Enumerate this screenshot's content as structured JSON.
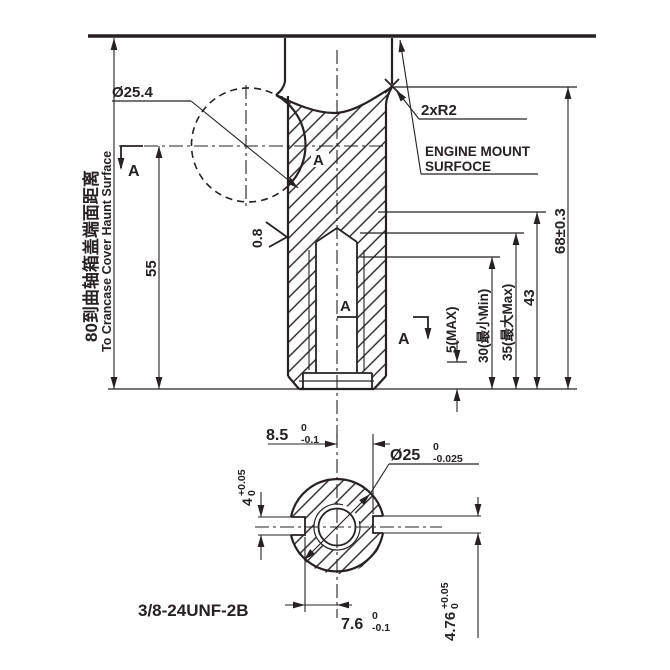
{
  "drawing": {
    "type": "engineering-dimension-drawing",
    "views": [
      "side-section-view",
      "section-A-A"
    ],
    "section_letter": "A",
    "left_dimension": {
      "zh": "80到曲轴箱盖端面距离",
      "en": "To Crancase Cover Haunt Surface",
      "value": "80"
    },
    "upper_view": {
      "dia_crankpin": "Ø25.4",
      "length_55": "55",
      "roughness": "0.8",
      "fillet_note": "2xR2",
      "mount_note_line1": "ENGINE MOUNT",
      "mount_note_line2": "SURFOCE",
      "depth_5max": "5(MAX)",
      "depth_30": "30(最小Min)",
      "depth_35": "35(最大Max)",
      "depth_43": "43",
      "length_68": "68±0.3"
    },
    "section_view": {
      "key_85": {
        "nominal": "8.5",
        "tol_upper": "0",
        "tol_lower": "-0.1"
      },
      "dia_25": {
        "nominal": "Ø25",
        "tol_upper": "0",
        "tol_lower": "-0.025"
      },
      "key_4": {
        "nominal": "4",
        "tol_upper": "+0.05",
        "tol_lower": "0"
      },
      "key_476": {
        "nominal": "4.76",
        "tol_upper": "+0.05",
        "tol_lower": "0"
      },
      "key_76": {
        "nominal": "7.6",
        "tol_upper": "0",
        "tol_lower": "-0.1"
      },
      "thread_spec": "3/8-24UNF-2B"
    },
    "line_color": "#272122",
    "background": "#ffffff"
  }
}
